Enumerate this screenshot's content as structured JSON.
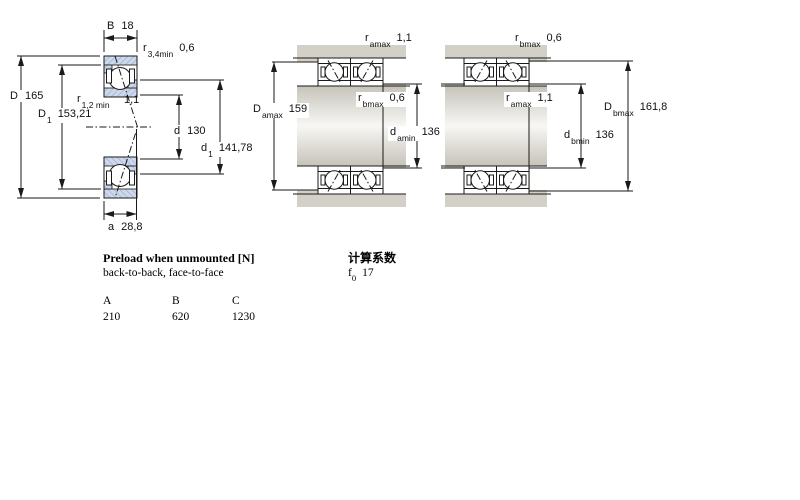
{
  "figure": {
    "type": "bearing-technical-drawing",
    "views": [
      "single bearing cross-section",
      "paired mounting arrangement a",
      "paired mounting arrangement b"
    ]
  },
  "dim_labels": [
    {
      "base": "B",
      "sub": "",
      "value": "18"
    },
    {
      "base": "r",
      "sub": "3,4min",
      "value": "0,6"
    },
    {
      "base": "D",
      "sub": "",
      "value": "165"
    },
    {
      "base": "D",
      "sub": "1",
      "value": "153,21"
    },
    {
      "base": "r",
      "sub": "1,2 min",
      "value": ""
    },
    {
      "base": "1,1",
      "sub": "",
      "value": ""
    },
    {
      "base": "d",
      "sub": "",
      "value": "130"
    },
    {
      "base": "d",
      "sub": "1",
      "value": "141,78"
    },
    {
      "base": "a",
      "sub": "",
      "value": "28,8"
    },
    {
      "base": "r",
      "sub": "amax",
      "value": "1,1"
    },
    {
      "base": "r",
      "sub": "bmax",
      "value": "0,6"
    },
    {
      "base": "D",
      "sub": "amax",
      "value": "159"
    },
    {
      "base": "d",
      "sub": "amin",
      "value": "136"
    },
    {
      "base": "r",
      "sub": "bmax",
      "value": "0,6"
    },
    {
      "base": "r",
      "sub": "amax",
      "value": "1,1"
    },
    {
      "base": "D",
      "sub": "bmax",
      "value": "161,8"
    },
    {
      "base": "d",
      "sub": "bmin",
      "value": "136"
    }
  ],
  "preload": {
    "title": "Preload when unmounted [N]",
    "subtitle": "back-to-back, face-to-face",
    "columns": [
      "A",
      "B",
      "C"
    ],
    "values": [
      "210",
      "620",
      "1230"
    ]
  },
  "calculation": {
    "title": "计算系数",
    "factor": {
      "base": "f",
      "sub": "0",
      "value": "17"
    }
  },
  "colors": {
    "ring_fill": "#ccd8ec",
    "ring_hatch": "#97a6c6",
    "housing_gray": "#d3d0c7",
    "line": "#1a1a1a",
    "background": "#ffffff"
  }
}
